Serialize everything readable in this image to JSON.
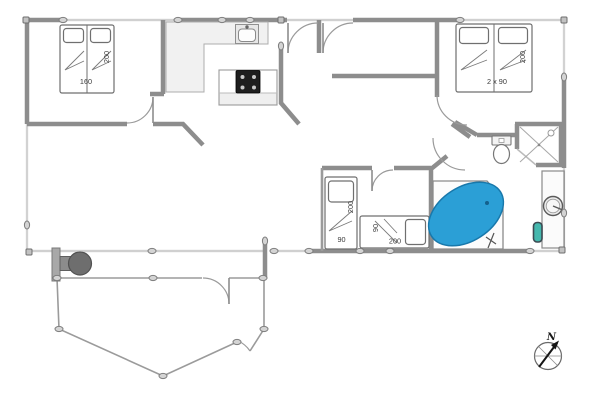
{
  "plan": {
    "labels": {
      "bedroom1_bed_width": "160",
      "bedroom1_bed_length": "200",
      "bedroom2_beds": "2 x 90",
      "bedroom2_bed_length": "200",
      "kidsroom_bed_vertical_length": "200",
      "kidsroom_bed_vertical_width": "90",
      "kidsroom_bed_horizontal_width": "90",
      "kidsroom_bed_horizontal_length": "200",
      "compass_north": "N"
    },
    "colors": {
      "wall": "#8d8d8d",
      "bathtub_blue": "#2b9fd6",
      "counter_gray": "#f1f1f1",
      "stove_dark": "#6e6e6e",
      "utility_teal": "#45b8ae"
    }
  }
}
